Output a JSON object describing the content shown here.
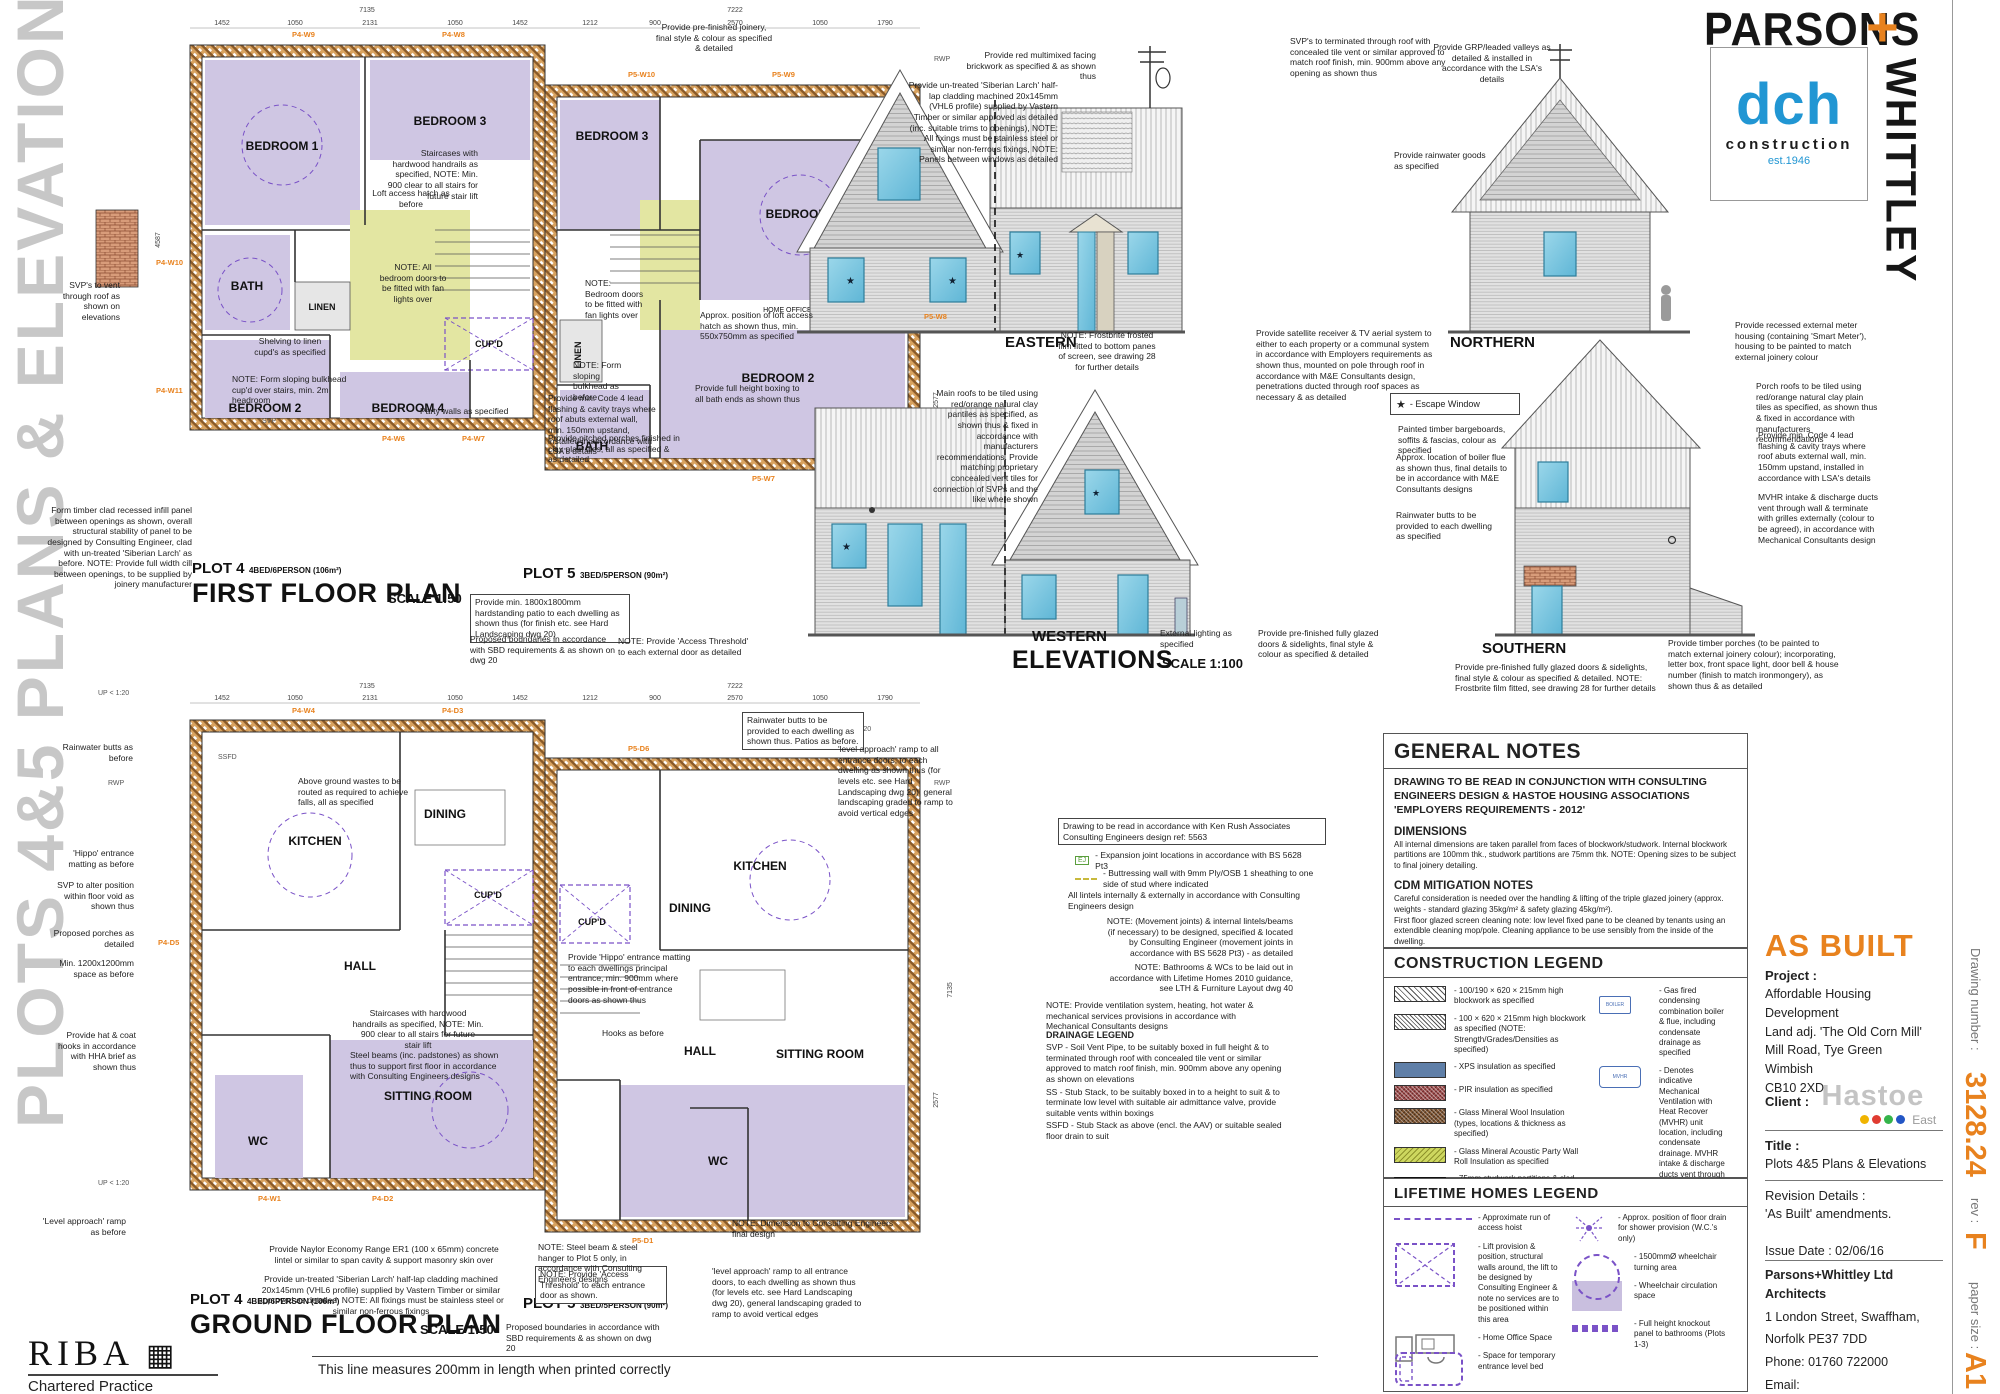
{
  "banner": {
    "text": "PLOTS 4&5 PLANS & ELEVATIONS"
  },
  "brand": {
    "parsons": "PARSONS",
    "plus": "+",
    "whittley": "WHITTLEY",
    "dch": "dch",
    "construction": "construction",
    "est": "est.1946"
  },
  "title_block": {
    "as_built": "AS BUILT",
    "project_label": "Project :",
    "project": [
      "Affordable Housing Development",
      "Land adj. 'The Old Corn Mill'",
      "Mill Road, Tye Green",
      "Wimbish",
      "CB10 2XD"
    ],
    "client_label": "Client :",
    "client_name": "Hastoe",
    "client_region": "East",
    "title_label": "Title :",
    "title": "Plots 4&5 Plans & Elevations",
    "revision_label": "Revision Details :",
    "revision": "'As Built' amendments.",
    "issue_date": "Issue Date : 02/06/16",
    "firm": "Parsons+Whittley Ltd Architects",
    "address1": "1 London Street, Swaffham,",
    "address2": "Norfolk PE37 7DD",
    "phone": "Phone: 01760 722000",
    "email": "Email: info@parsonswhittley.co.uk",
    "website": "www.parsonswhittley.co.uk",
    "drawing_number_label": "Drawing number :",
    "drawing_number": "3128.24",
    "rev_label": "rev :",
    "rev": "F",
    "paper_label": "paper size :",
    "paper": "A1"
  },
  "footer": {
    "riba": "RIBA",
    "riba_sub": "Chartered Practice",
    "scale_note": "This line measures 200mm in length when printed correctly"
  },
  "plans": {
    "ff": {
      "plot4": "PLOT 4",
      "plot4_spec": "4BED/6PERSON (106m²)",
      "plot5": "PLOT 5",
      "plot5_spec": "3BED/5PERSON (90m²)",
      "title": "FIRST FLOOR PLAN",
      "scale": "SCALE 1:50"
    },
    "gf": {
      "title": "GROUND FLOOR PLAN",
      "scale": "SCALE 1:50"
    },
    "rooms": {
      "bedroom1": "BEDROOM 1",
      "bedroom2": "BEDROOM 2",
      "bedroom3": "BEDROOM 3",
      "bedroom4": "BEDROOM 4",
      "bath": "BATH",
      "linen": "LINEN",
      "cupd": "CUP'D",
      "kitchen": "KITCHEN",
      "dining": "DINING",
      "hall": "HALL",
      "wc": "WC",
      "sitting": "SITTING ROOM",
      "home_office": "HOME OFFICE SPACE"
    },
    "dims": {
      "p4": [
        "1452",
        "1050",
        "2131",
        "1050",
        "1452"
      ],
      "p4_total": "7135",
      "p5": [
        "1212",
        "900",
        "2570",
        "1050",
        "1790"
      ],
      "p5_total": "7222",
      "h_left": "4587",
      "h_right1": "4208",
      "h_right2": "7135",
      "h_right3": "2577"
    },
    "tags": {
      "ff": [
        "P4-W9",
        "P4-W8",
        "P5-W10",
        "P5-W9",
        "P4-W10",
        "P4-W11",
        "P4-W6",
        "P4-W7",
        "P5-W7",
        "P5-W8"
      ],
      "gf": [
        "P4-W4",
        "P4-D3",
        "P5-D6",
        "P4-D5",
        "P4-W1",
        "P4-D2",
        "P5-D1"
      ],
      "rwp": "RWP",
      "svp": "SVP",
      "ssfd": "SSFD",
      "up": "UP < 1:20"
    }
  },
  "elevations": {
    "eastern": "EASTERN",
    "northern": "NORTHERN",
    "western": "WESTERN",
    "southern": "SOUTHERN",
    "title": "ELEVATIONS",
    "scale": "SCALE 1:100",
    "escape_star": "★",
    "escape_label": "- Escape Window"
  },
  "notes": {
    "ff": {
      "svp_vent": "SVP's to vent through roof as shown on elevations",
      "infill_panel": "Form timber clad recessed infill panel between openings as shown, overall structural stability of panel to be designed by Consulting Engineer, clad with un-treated 'Siberian Larch' as before. NOTE: Provide full width cill between openings, to be supplied by joinery manufacturer",
      "prefinished_joinery": "Provide pre-finished joinery, final style & colour as specified & detailed",
      "loft_access": "Loft access hatch as before",
      "staircases": "Staircases with hardwood handrails as specified, NOTE: Min. 900 clear to all stairs for future stair lift",
      "fan_lights": "NOTE: All bedroom doors to be fitted with fan lights over",
      "shelving": "Shelving to linen cupd's as specified",
      "bulkhead": "NOTE: Form sloping bulkhead cup'd over stairs, min. 2m headroom",
      "party_walls": "Party walls as specified",
      "fan_lights5": "NOTE: Bedroom doors to be fitted with fan lights over",
      "loft_hatch5": "Approx. position of loft access hatch as shown thus, min. 550x750mm as specified",
      "bulkhead5": "NOTE: Form sloping bulkhead as before",
      "bath_boxing": "Provide full height boxing to all bath ends as shown thus",
      "lead_flashing": "Provide min. Code 4 lead flashing & cavity trays where roof abuts external wall, min. 150mm upstand, installed in accordance with LSA's details",
      "porches": "Provide pitched porches finished in clay plain tiles, all as specified & as detailed",
      "patio": "Provide min. 1800x1800mm hardstanding patio to each dwelling as shown thus (for finish etc. see Hard Landscaping dwg 20)",
      "boundaries": "Proposed boundaries in accordance with SBD requirements & as shown on   dwg 20"
    },
    "gf": {
      "wastes": "Above ground wastes to be routed as required to achieve falls, all as specified",
      "steel_beams": "Steel beams (inc. padstones) as shown thus to support first floor in accordance with Consulting Engineers designs",
      "rain_butts": "Rainwater butts to be provided to each dwelling as shown thus. Patios as before.",
      "ramp": "'level approach' ramp to all entrance doors, to each dwelling as shown thus (for levels etc. see Hard Landscaping dwg 20), general landscaping graded to ramp to avoid vertical edges",
      "threshold": "NOTE: Provide 'Access Threshold' to each entrance door as shown.",
      "threshold2": "NOTE: Provide 'Access Threshold' to each external door as detailed",
      "lintel": "Provide Naylor Economy Range ER1 (100 x 65mm) concrete lintel or similar to span cavity & support masonry skin over",
      "larch": "Provide un-treated 'Siberian Larch' half-lap cladding machined 20x145mm (VHL6 profile) supplied by Vastern Timber or similar approved as detailed, NOTE: All fixings must be stainless steel or similar non-ferrous fixings",
      "steel_hanger": "NOTE: Steel beam & steel hanger to Plot 5 only, in accordance with Consulting Engineers designs",
      "dim_engineers": "NOTE: Dimension to Consulting Engineers final design",
      "hippo": "Provide 'Hippo' entrance matting to each dwellings principal entrance, min. 900mm where possible in front of entrance doors as shown thus",
      "butts_before": "Rainwater butts as before",
      "hippo_before": "'Hippo' entrance matting as before",
      "svp_alter": "SVP to alter position within floor void as shown thus",
      "porches_det": "Proposed porches as detailed",
      "space_before": "Min. 1200x1200mm space as before",
      "hooks": "Provide hat & coat hooks in accordance with HHA brief as shown thus",
      "hooks_before": "Hooks as before",
      "ramp_before": "'Level approach' ramp as before"
    },
    "elev": {
      "brickwork": "Provide red multimixed facing brickwork as specified & as shown thus",
      "larch": "Provide un-treated 'Siberian Larch' half-lap cladding machined 20x145mm (VHL6 profile) supplied by Vastern Timber or similar approved as detailed (inc. suitable trims to openings), NOTE: All fixings must be stainless steel or similar non-ferrous fixings, NOTE: Panels between windows as detailed",
      "svp_roof": "SVP's to terminated through roof with concealed tile vent or similar approved to match roof finish, min. 900mm above any opening as shown thus",
      "grp_valleys": "Provide GRP/leaded valleys as detailed & installed in accordance with the LSA's details",
      "rainwater_goods": "Provide rainwater goods as specified",
      "frostbrite": "NOTE: Frostbrite frosted film fitted to bottom panes of screen, see drawing 28 for further details",
      "satellite": "Provide satellite receiver & TV aerial system to   either   to each property or a communal system in accordance with Employers requirements as shown thus, mounted on pole through roof in accordance with M&E Consultants design, penetrations ducted through roof spaces as necessary & as detailed",
      "main_roofs": "Main roofs  to be tiled using red/orange natural clay pantiles as specified, as shown thus & fixed in accordance with manufacturers recommendations. Provide matching proprietary concealed vent tiles for connection of SVPs and the like where shown",
      "bargeboards": "Painted timber bargeboards, soffits & fascias, colour as specified",
      "boiler_flue": "Approx. location of boiler flue as shown thus, final details to be in accordance with M&E Consultants designs",
      "meter": "Provide recessed external meter housing (containing 'Smart Meter'), housing to be painted to match external joinery colour",
      "butts": "Rainwater butts to be provided to each dwelling as specified",
      "lighting": "External lighting as specified",
      "glazed_doors": "Provide pre-finished fully glazed doors & sidelights, final style & colour as specified & detailed",
      "glazed_doors_frost": "Provide pre-finished fully glazed doors & sidelights, final style & colour as specified & detailed.  NOTE: Frostbrite film fitted, see drawing 28 for further details",
      "porch_roofs": "Porch roofs  to be tiled using red/orange natural clay plain tiles as specified, as shown thus & fixed in accordance with manufacturers recommendations",
      "mvhr": "MVHR intake & discharge ducts vent through wall & terminate with grilles externally (colour to be agreed), in accordance with Mechanical Consultants design",
      "timber_porches": "Provide timber porches (to be painted to match external joinery colour); incorporating, letter box, front space light, door bell & house number (finish to match ironmongery), as shown thus & as detailed"
    },
    "mid": {
      "ken_rush": "Drawing to be read in accordance with Ken Rush Associates Consulting Engineers design ref:  5563",
      "ej": "EJ",
      "ej_text": "- Expansion joint locations in accordance with BS 5628 Pt3",
      "buttress": "- Buttressing wall with 9mm Ply/OSB 1 sheathing to one side of stud where indicated",
      "lintels": "All lintels internally & externally in accordance with Consulting Engineers design",
      "movement": "NOTE: (Movement joints) & internal lintels/beams (if necessary) to be designed, specified & located by Consulting Engineer (movement joints in accordance with BS 5628 Pt3)  - as detailed",
      "bathrooms": "NOTE: Bathrooms & WCs to be laid out in accordance with Lifetime Homes 2010 guidance, see LTH & Furniture Layout   dwg 40",
      "ventilation": "NOTE: Provide ventilation system, heating, hot water & mechanical services provisions in accordance with Mechanical Consultants designs",
      "drainage_title": "DRAINAGE LEGEND",
      "svp": "SVP - Soil Vent Pipe, to be suitably boxed in full height & to terminated through roof with concealed tile vent or similar approved to match roof finish, min. 900mm above any opening as shown on elevations",
      "ss": "SS - Stub Stack, to be suitably boxed in to a height to suit & to terminate low level with suitable air admittance valve, provide suitable vents within boxings",
      "ssfd": "SSFD - Stub Stack as above (encl. the AAV) or suitable sealed floor drain to suit"
    }
  },
  "general_notes": {
    "title": "GENERAL NOTES",
    "intro": "DRAWING TO BE READ IN CONJUNCTION WITH CONSULTING ENGINEERS DESIGN & HASTOE HOUSING ASSOCIATIONS 'EMPLOYERS REQUIREMENTS - 2012'",
    "dim_title": "DIMENSIONS",
    "dim_body": "All internal dimensions are taken parallel from faces of blockwork/studwork. Internal blockwork partitions are 100mm thk., studwork partitions are 75mm thk. NOTE: Opening sizes to be subject to final joinery detailing.",
    "cdm_title": "CDM MITIGATION NOTES",
    "cdm_body1": "Careful consideration is needed over the handling & lifting of the triple glazed joinery (approx. weights - standard glazing 35kg/m² & safety glazing 45kg/m²).",
    "cdm_body2": "First floor glazed screen cleaning note: low level    fixed pane to be cleaned by tenants using an extendible cleaning mop/pole. Cleaning appliance to be use sensibly from the inside of the dwelling.",
    "cdm_body3": "Porches are to be fixed towards the end of the project and are     not  to be used under any circumstances as a temporary working platform."
  },
  "construction_legend": {
    "title": "CONSTRUCTION LEGEND",
    "items": [
      "- 100/190 × 620 × 215mm high blockwork as specified",
      "- 100 × 620 × 215mm high blockwork as specified (NOTE: Strength/Grades/Densities as specified)",
      "- XPS insulation as specified",
      "- PIR insulation as specified",
      "- Glass Mineral Wool Insulation (types, locations & thickness as specified)",
      "- Glass Mineral Acoustic Party Wall Roll Insulation as specified",
      "- 75mm studwork partitions  & clad both sides with 15mm Gyproc SoundBloc  plasterboard as specified. NOTE: All studwork partitions within WCs & Bathrooms are to be lined with 25mm plywood sheathing between studs, to accommodate future fixing of mobility fittings"
    ],
    "boiler_icon": "BOILER",
    "mvhr_icon": "MVHR",
    "right": [
      "- Gas fired condensing combination boiler & flue, including condensate drainage as specified",
      "- Denotes indicative Mechanical Ventilation with Heat Recover (MVHR) unit location, including condensate drainage. MVHR intake & discharge ducts vent through wall & terminate with grilles externally (colour to be agreed), all in accordance with Mechanical Consultants design",
      "- Lowered ceilings/boxings to suit Mechanical Consultants ventilation ductwork distribution design (min. 175 clear voids)"
    ]
  },
  "lifetime_legend": {
    "title": "LIFETIME HOMES LEGEND",
    "left": [
      "- Approximate run of access hoist",
      "- Lift provision & position, structural walls around, the lift to be designed by Consulting Engineer & note no services are to be positioned within this area",
      "- Home Office Space",
      "- Space for temporary entrance level bed"
    ],
    "right": [
      "- Approx. position of floor drain for shower provision (W.C.'s only)",
      "- 1500mmØ wheelchair turning area",
      "- Wheelchair circulation space",
      "- Full height knockout panel to bathrooms (Plots 1-3)"
    ]
  }
}
